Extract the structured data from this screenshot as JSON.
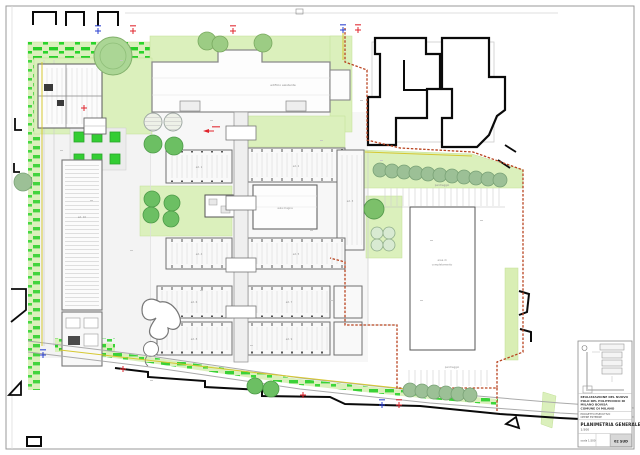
{
  "titleblock": {
    "project_lines": [
      "REALIZZAZIONE DEL NUOVO",
      "POLO DEL POLITECNICO DI",
      "MILANO BOVISA",
      "COMUNE DI MILANO"
    ],
    "subtitle_lines": [
      "PROGETTO ESECUTIVO",
      "OPERE ESTERNE"
    ],
    "drawing_title": "PLANIMETRIA GENERALE",
    "scale_label": "1:500",
    "bottom_left_label": "scala 1:500",
    "sheet_code": "02 SUD"
  },
  "plan_labels": {
    "existing_building": "edificio esistente",
    "hall": "aula magna",
    "left_building": "ed. 10",
    "parking_upper": "parcheggio",
    "parking_lower": "parcheggio",
    "future_area_line1": "area di",
    "future_area_line2": "completamento",
    "buildings": [
      "ed. 1",
      "ed. 2",
      "ed. 3",
      "ed. 4",
      "ed. 5",
      "ed. 6",
      "ed. 7",
      "ed. 8",
      "ed. 9"
    ]
  },
  "colors": {
    "lawn_green": "#dbf0bc",
    "shrub_green": "#28cf28",
    "tree_dark_green": "#6cbf63",
    "tree_sage_green": "#9cc096",
    "boundary_red": "#b8431f",
    "boundary_yellow": "#d6c832",
    "marker_red": "#e0242c",
    "marker_blue": "#2a3fd0",
    "adjacent_building_black": "#0a0a0a"
  }
}
